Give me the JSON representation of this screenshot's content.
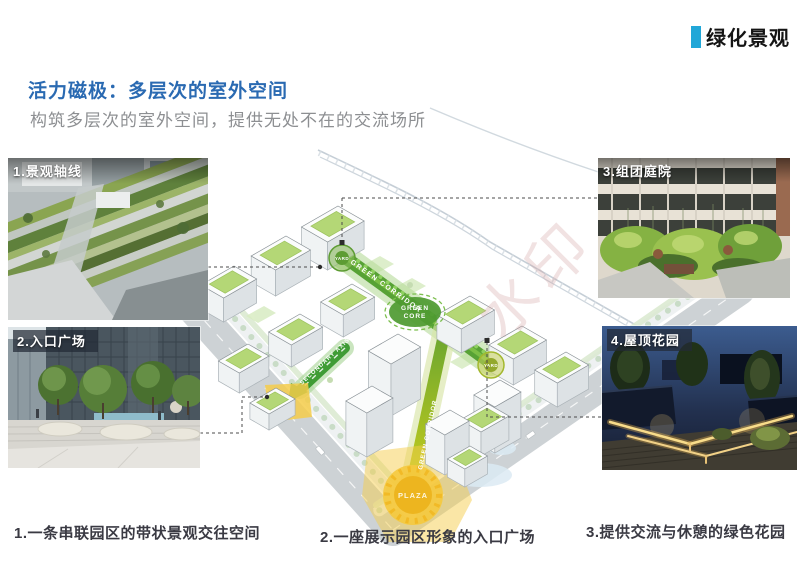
{
  "header": {
    "tag_label": "绿化景观"
  },
  "title": "活力磁极：多层次的室外空间",
  "subtitle": "构筑多层次的室外空间，提供无处不在的交流场所",
  "photos": {
    "p1": {
      "label": "1.景观轴线"
    },
    "p2": {
      "label": "2.入口广场"
    },
    "p3": {
      "label": "3.组团庭院"
    },
    "p4": {
      "label": "4.屋顶花园"
    }
  },
  "diagram": {
    "green_corridor_main": "GREEN CORRIDOR",
    "green_corridor_south": "GREEN CORRIDOR",
    "green_core_line1": "GREEN",
    "green_core_line2": "CORE",
    "yard1": "YARD",
    "yard2": "YARD",
    "secondary_axis": "SECONDARY AXIS",
    "plaza": "PLAZA",
    "watermark": "水印"
  },
  "captions": {
    "c1": "1.一条串联园区的带状景观交往空间",
    "c2": "2.一座展示园区形象的入口广场",
    "c3": "3.提供交流与休憩的绿色花园"
  },
  "colors": {
    "accent_cyan": "#21a7d8",
    "title_blue": "#2a6ab2",
    "corridor_green": "#57a235",
    "plaza_yellow": "#f5c93e"
  }
}
